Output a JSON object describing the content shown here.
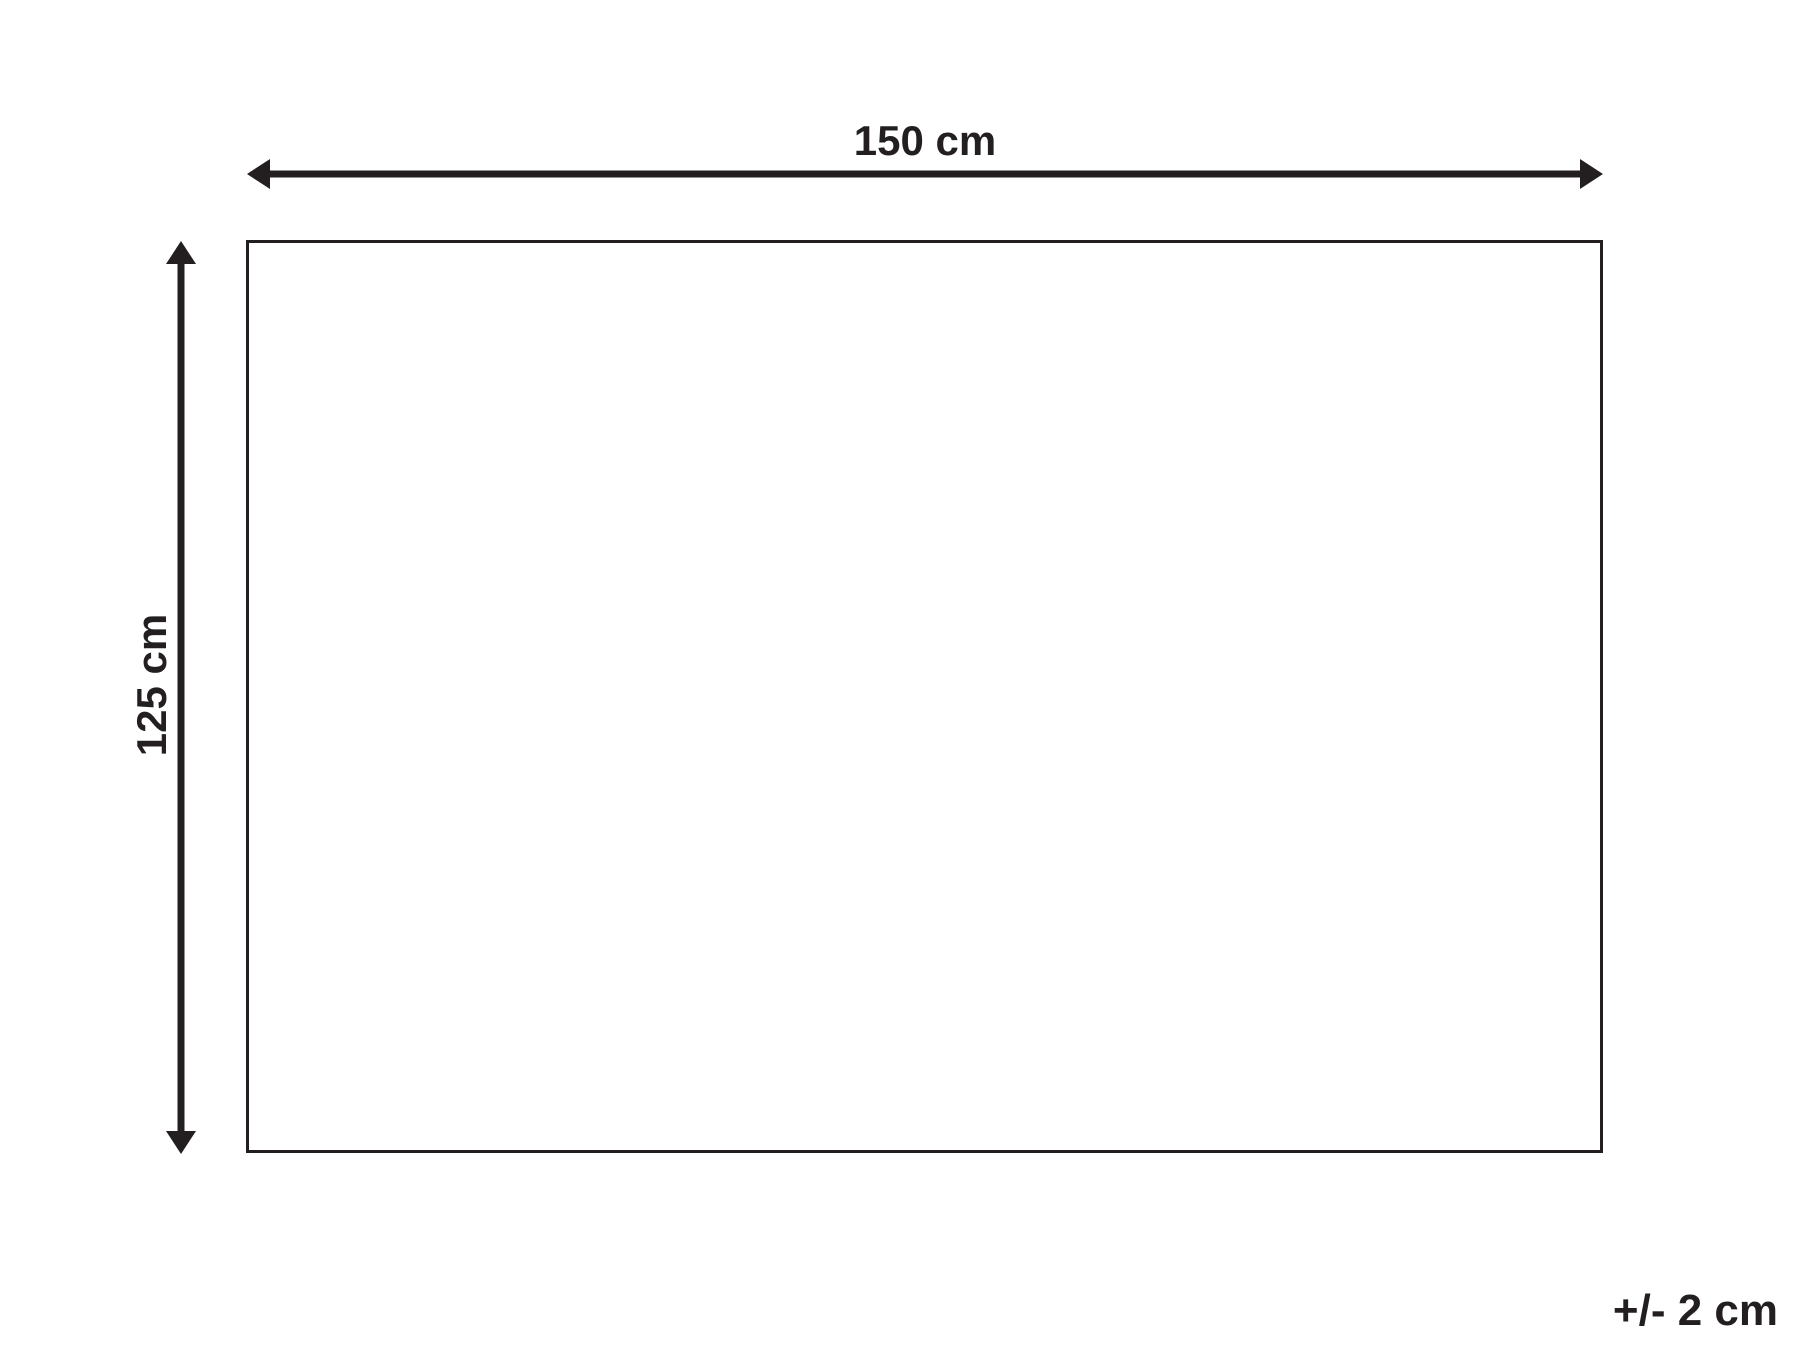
{
  "diagram": {
    "width_label": "150 cm",
    "height_label": "125 cm",
    "tolerance_label": "+/- 2 cm",
    "line_color": "#231f20",
    "background_color": "#ffffff"
  }
}
